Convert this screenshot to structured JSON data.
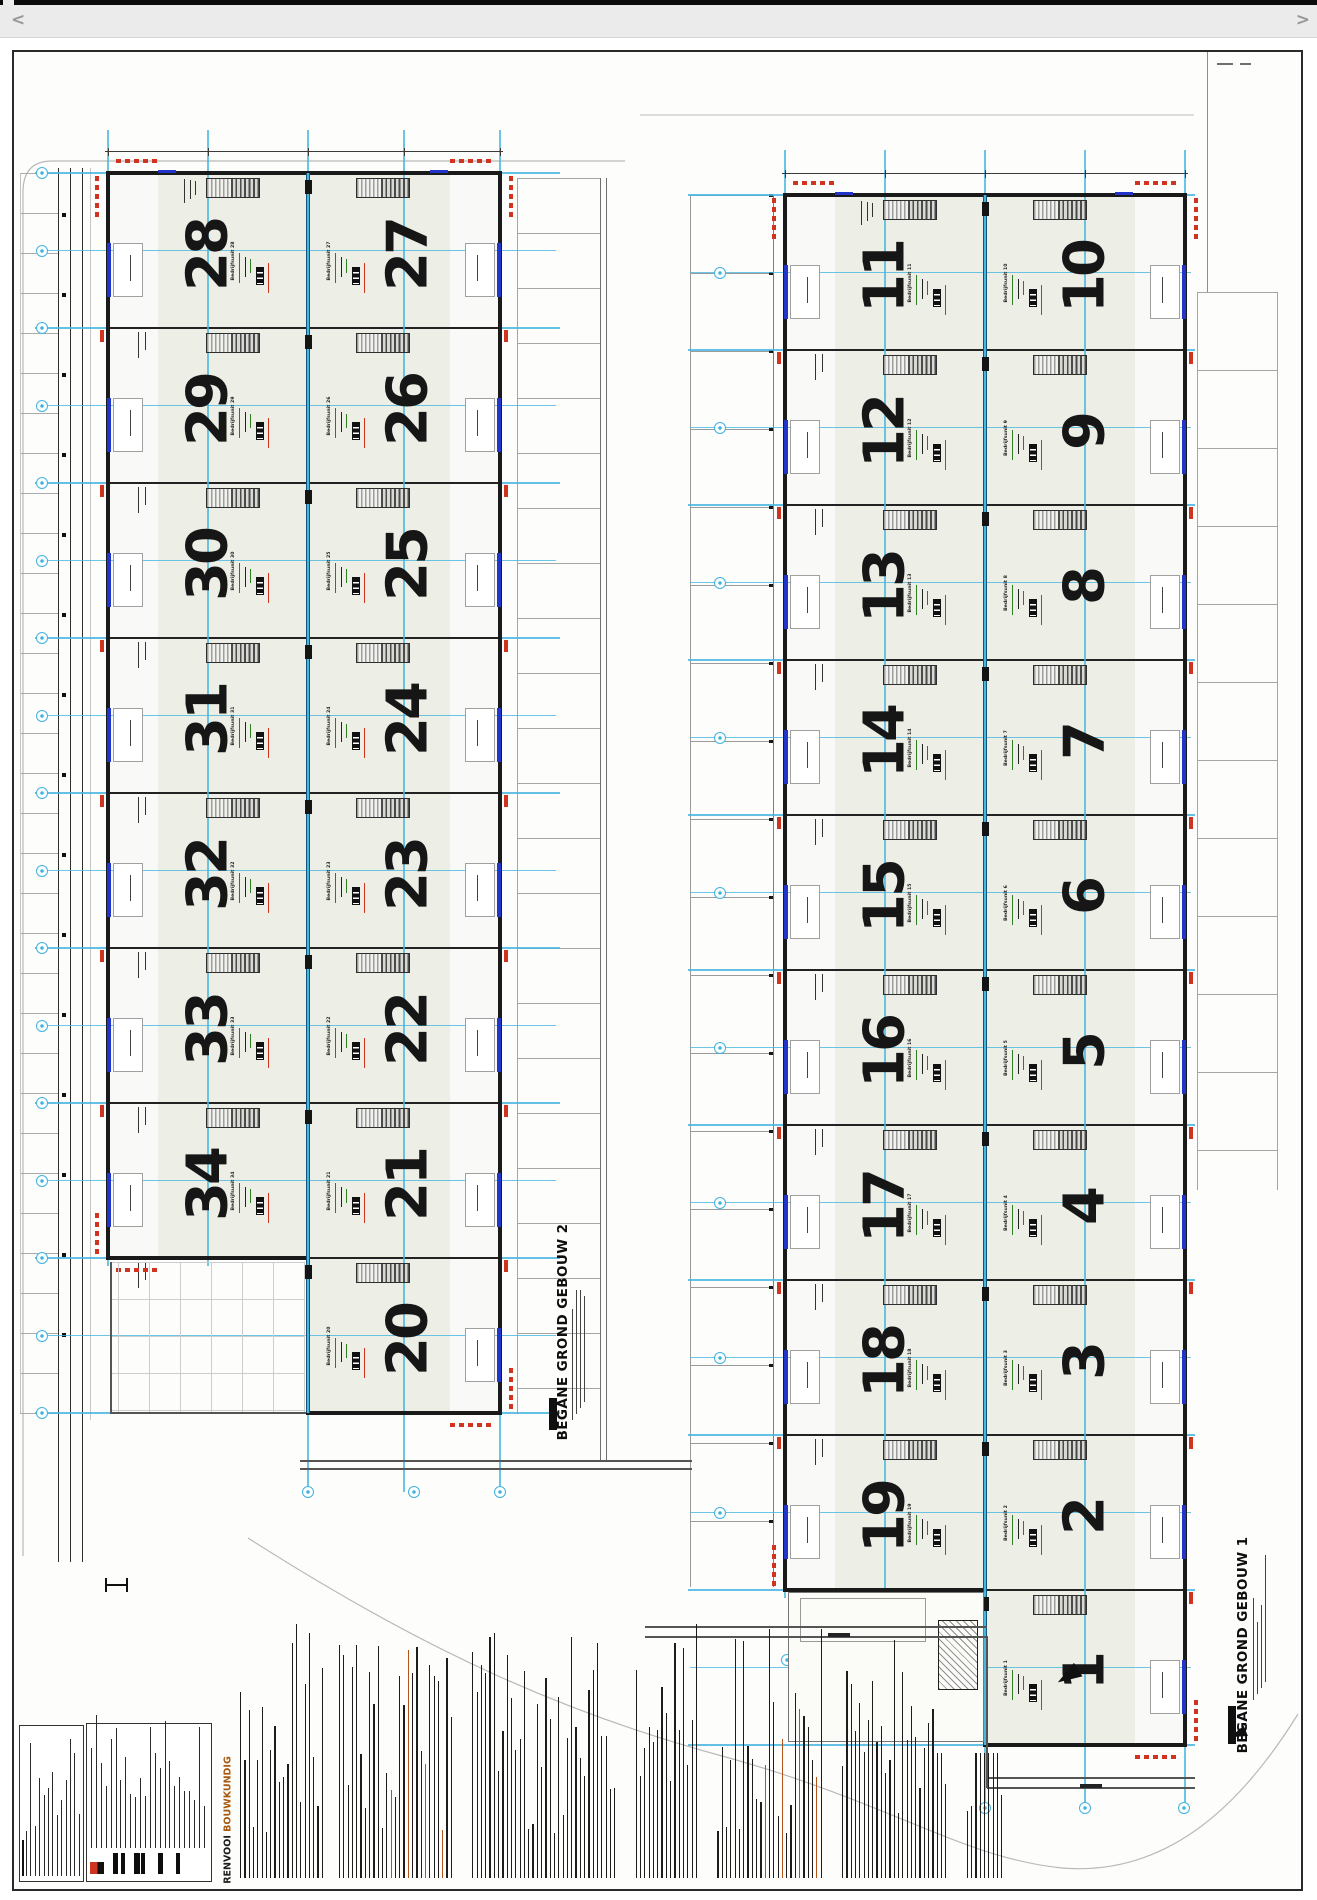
{
  "viewer": {
    "prev": "<",
    "next": ">"
  },
  "sheet": {
    "building2": {
      "title": "BEGANE GROND GEBOUW 2",
      "left_units": [
        28,
        29,
        30,
        31,
        32,
        33,
        34
      ],
      "right_units": [
        27,
        26,
        25,
        24,
        23,
        22,
        21,
        20
      ]
    },
    "building1": {
      "title": "BEGANE GROND GEBOUW 1",
      "left_units": [
        11,
        12,
        13,
        14,
        15,
        16,
        17,
        18,
        19
      ],
      "right_units": [
        10,
        9,
        8,
        7,
        6,
        5,
        4,
        3,
        2,
        1
      ]
    },
    "unit_label_prefix": "Bedrijfsunit",
    "legend_black": "RENVOOI",
    "legend_orange": "BOUWKUNDIG",
    "colors": {
      "grid_cyan": "#49b6e0",
      "spine_teal": "#10557a",
      "wall_black": "#1a1a1a",
      "unit_fill": "#edefe7",
      "door_blue": "#2135c8",
      "marker_red": "#cf3420",
      "info_green": "#2f7d22",
      "info_black": "#222222",
      "legend_orange_hex": "#a85a10"
    }
  }
}
